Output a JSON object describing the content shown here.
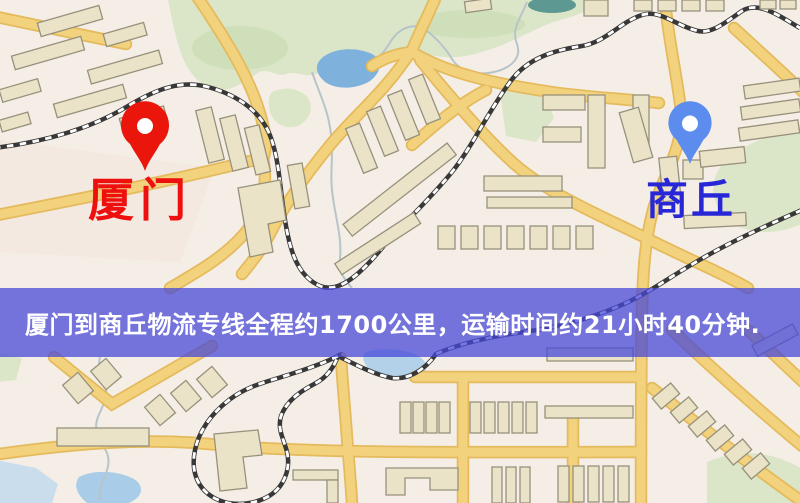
{
  "map": {
    "origin_label": "厦门",
    "destination_label": "商丘",
    "origin_marker_color": "#ea150b",
    "origin_label_color": "#ee0f0f",
    "destination_marker_color": "#5b8cee",
    "destination_label_color": "#2727d8"
  },
  "banner": {
    "text": "厦门到商丘物流专线全程约1700公里，运输时间约21小时40分钟.",
    "background_color": "rgba(70,72,216,0.74)",
    "text_color": "#ffffff"
  },
  "route_info": {
    "origin": "厦门",
    "destination": "商丘",
    "distance": "约1700公里",
    "duration": "约21小时40分钟"
  }
}
